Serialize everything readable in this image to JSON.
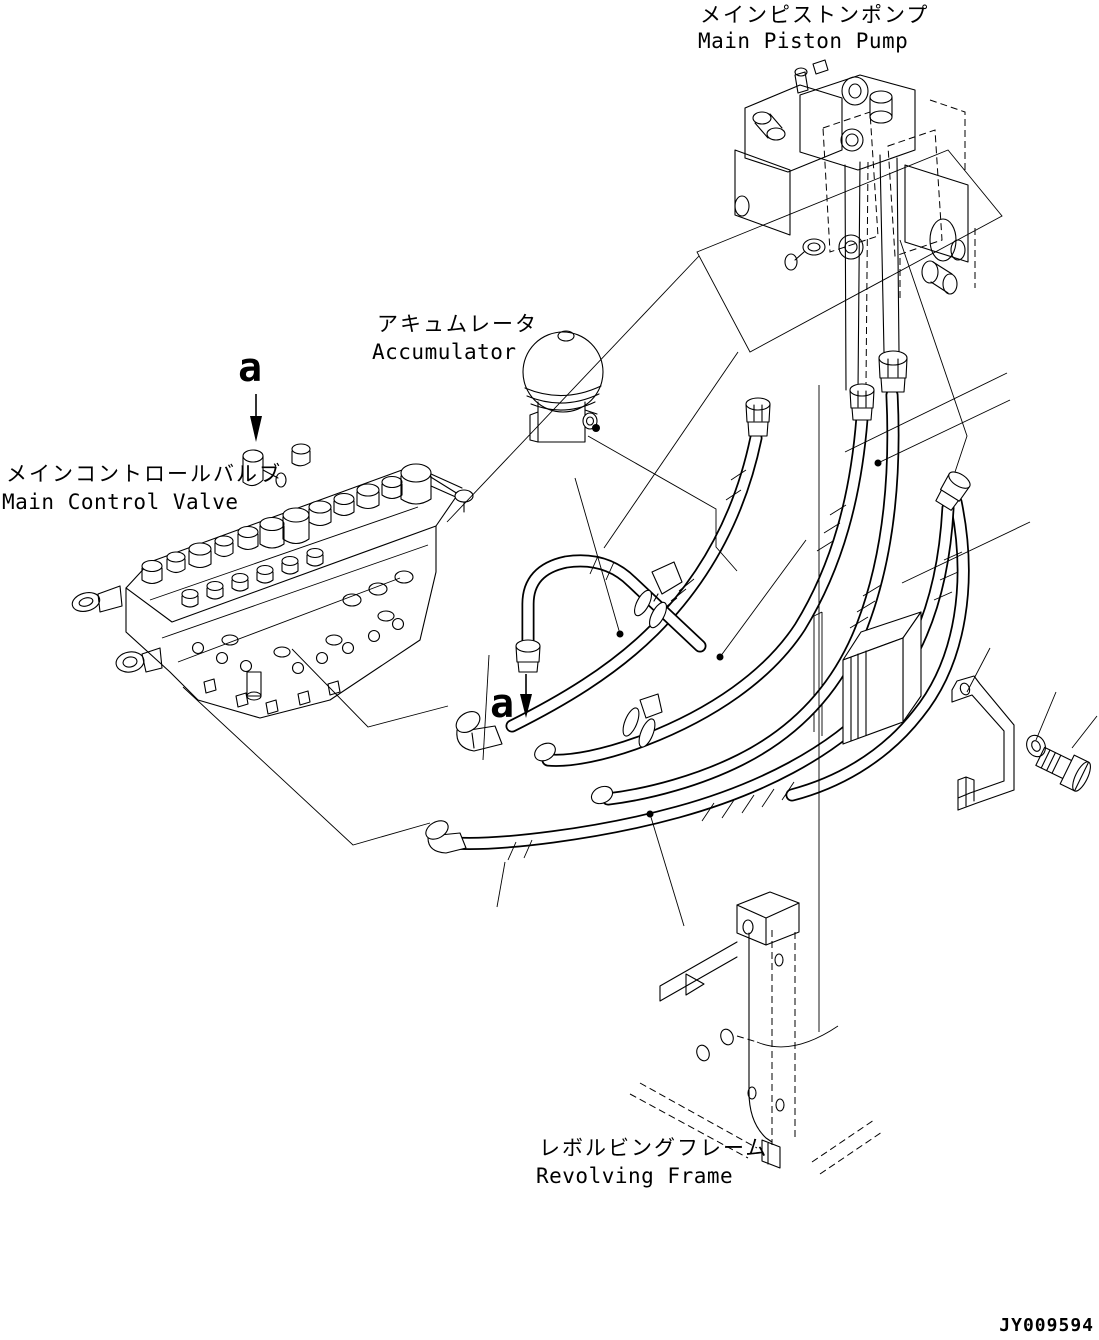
{
  "colors": {
    "background": "#ffffff",
    "line": "#000000"
  },
  "labels": {
    "main_piston_pump": {
      "jp": "メインピストンポンプ",
      "en": "Main Piston Pump"
    },
    "accumulator": {
      "jp": "アキュムレータ",
      "en": "Accumulator"
    },
    "main_control_valve": {
      "jp": "メインコントロールバルブ",
      "en": "Main Control Valve"
    },
    "revolving_frame": {
      "jp": "レボルビングフレーム",
      "en": "Revolving Frame"
    }
  },
  "section_markers": {
    "upper": "a",
    "lower": "a"
  },
  "drawing_number": "JY009594"
}
